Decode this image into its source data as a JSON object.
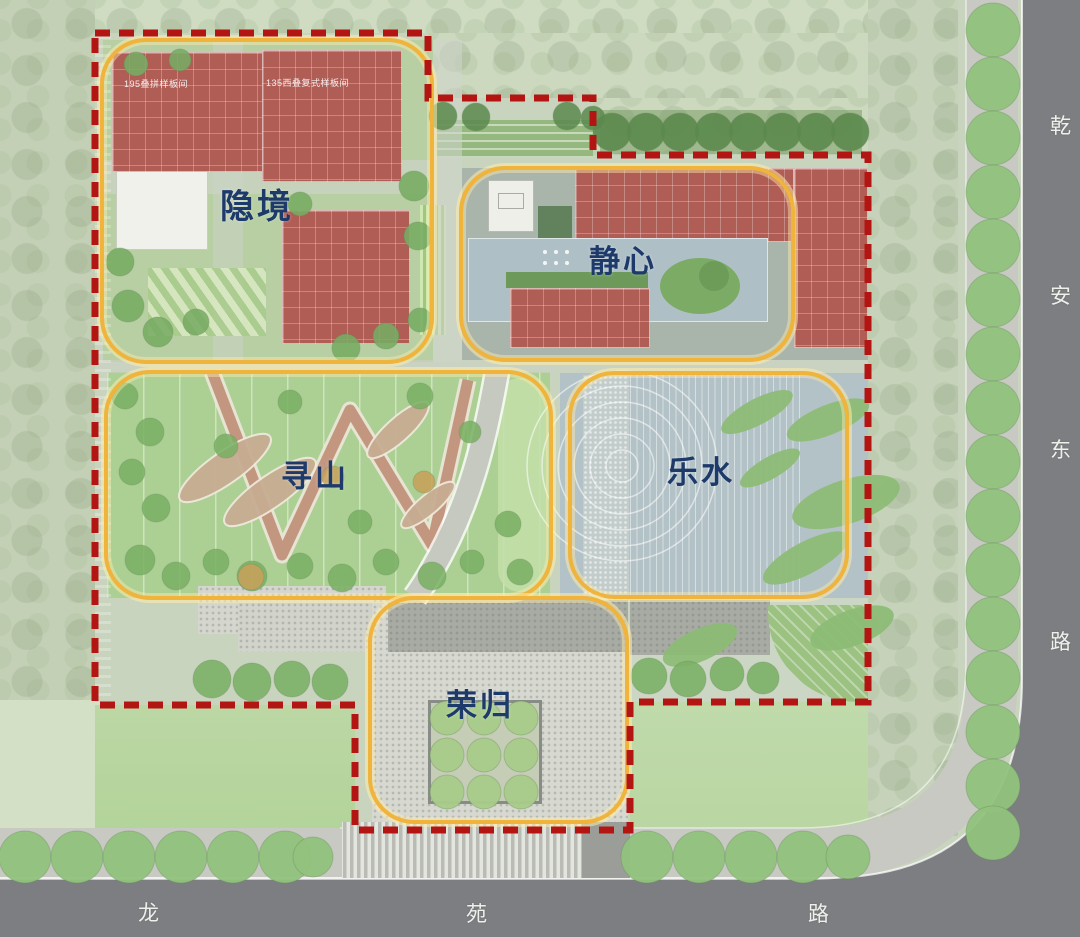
{
  "colors": {
    "zone_outline": "#f0b43c",
    "boundary_line": "#b31513",
    "zone_label": "#1d3a6b",
    "road_surface": "#7d7e81",
    "sidewalk": "#c7c9c2",
    "building_red": "#b05d55",
    "water": "#aec0c6",
    "road_text": "#eef0ec"
  },
  "zones": [
    {
      "id": "yinjing",
      "label": "隐境"
    },
    {
      "id": "jingxin",
      "label": "静心"
    },
    {
      "id": "xunshan",
      "label": "寻山"
    },
    {
      "id": "leshui",
      "label": "乐水"
    },
    {
      "id": "ronggui",
      "label": "荣归"
    }
  ],
  "annotations": {
    "building_a": "195叠拼样板间",
    "building_b": "135西叠复式样板间"
  },
  "roads": {
    "east": {
      "name": "乾安东路",
      "chars": [
        "乾",
        "安",
        "东",
        "路"
      ]
    },
    "south": {
      "name": "龙苑路",
      "chars": [
        "龙",
        "苑",
        "路"
      ]
    }
  }
}
